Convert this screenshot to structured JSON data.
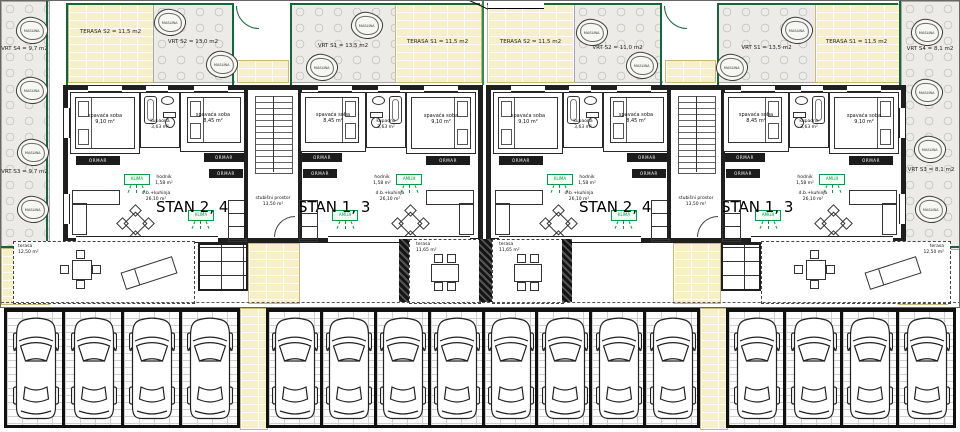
{
  "plan": {
    "boundary_label": "MEĐA",
    "tree_label": "MASLINA",
    "gardens": {
      "left_top": "VRT S4 = 9,7 m2",
      "left_mid": "VRT S3 = 9,7 m2",
      "right_top": "VRT S4 = 8,1 m2",
      "right_mid": "VRT S3 = 8,1 m2",
      "b1_terasa_s2": "TERASA S2 = 11,5 m2",
      "b1_vrt_s2": "VRT S2 = 13,0 m2",
      "b1_vrt_s1": "VRT S1 = 13,5 m2",
      "b1_terasa_s1": "TERASA S1 = 11,5 m2",
      "b2_terasa_s2": "TERASA S2 = 11,5 m2",
      "b2_vrt_s2": "VRT S2 = 11,0 m2",
      "b2_vrt_s1": "VRT S1 = 13,5 m2",
      "b2_terasa_s1": "TERASA S1 = 11,5 m2"
    },
    "rooms": {
      "bedroom_name": "spavaća soba",
      "bedroom_large_area": "9,10 m²",
      "bedroom_small_area": "8,45 m²",
      "bath_name": "kupaona",
      "bath_area": "3,63 m²",
      "hall_name": "hodnik",
      "hall_area": "1,58 m²",
      "living_name": "d.b.+kuhinja",
      "living_area": "26,10 m²",
      "stairs_name": "stubišni prostor",
      "stairs_area": "13,50 m²",
      "wardrobe_label": "ORMAR",
      "ac_label": "KLIMA"
    },
    "units": {
      "left": "STAN 2, 4",
      "right": "STAN 1, 3"
    },
    "terraces": {
      "outer_name": "terasa",
      "outer_area": "12,50 m²",
      "inner_name": "terasa",
      "inner_area": "11,65 m²"
    },
    "parking": {
      "stall_groups": [
        4,
        8,
        4
      ],
      "total_stalls": 16
    },
    "colors": {
      "terrace_brick": "#f7efc7",
      "garden_stone": "#ecebe7",
      "hedge_green": "#17663b",
      "ac_green": "#0a9a44",
      "wall_dark": "#1f1f1f"
    }
  }
}
